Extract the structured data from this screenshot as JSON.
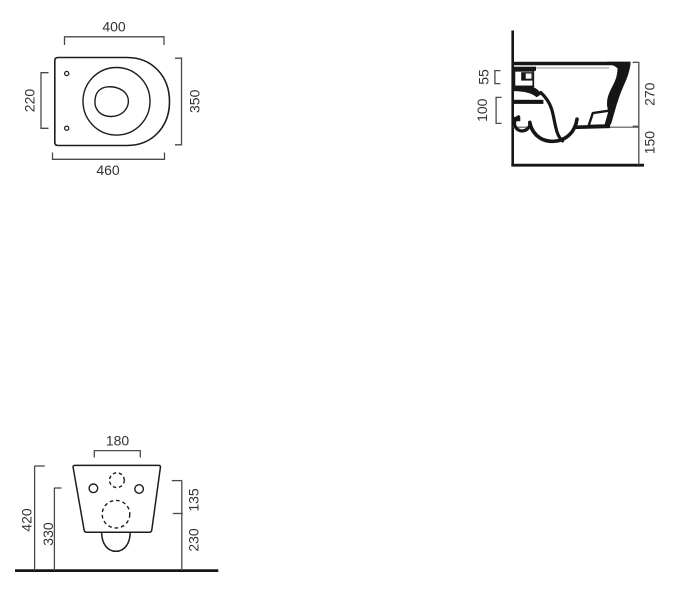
{
  "drawing": {
    "title": "wall-hung-wc-technical-drawing",
    "views": {
      "plan": {
        "dim_top_width": "400",
        "dim_fixing_centres": "220",
        "dim_depth": "350",
        "dim_overall_width": "460"
      },
      "side": {
        "dim_inlet_height": "55",
        "dim_outlet_height": "100",
        "dim_body_height": "270",
        "dim_floor_clearance": "150"
      },
      "front": {
        "dim_fixing_span": "180",
        "dim_total_height": "420",
        "dim_fixing_height": "330",
        "dim_inlet_offset": "135",
        "dim_outlet_centre_height": "230"
      }
    },
    "colors": {
      "object_line": "#1d1d1d",
      "solid_fill": "#161616",
      "dim_line": "#4a4a4a",
      "thin_line": "#9a9a9a",
      "background": "#ffffff"
    }
  }
}
